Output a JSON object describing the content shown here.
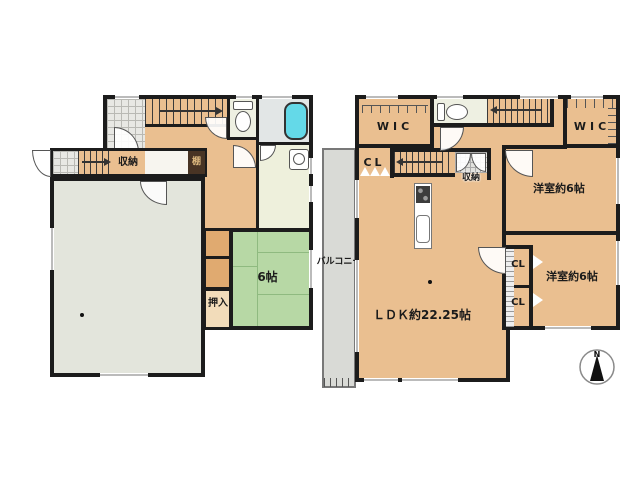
{
  "plan1f": {
    "storage_label": "収納",
    "shelf_label": "棚",
    "oshiire_label": "押入",
    "tatami_size_label": "6帖"
  },
  "plan2f": {
    "wic_left_label": "WIC",
    "wic_right_label": "WIC",
    "hall_closet_label": "CL",
    "storage_label": "収納",
    "bedroom_top_label": "洋室約6帖",
    "bedroom_bottom_label": "洋室約6帖",
    "closet_upper_label": "CL",
    "closet_lower_label": "CL",
    "ldk_label": "ＬＤＫ約22.25帖",
    "balcony_label": "バルコニー"
  },
  "compass": {
    "north_label": "N"
  },
  "colors": {
    "wall": "#1c1c1c",
    "wood_floor": "#eabf90",
    "tatami_green": "#b7d8a5",
    "large_room_gray": "#e3e5dc",
    "balcony_gray": "#d9dad6",
    "bathtub_cyan": "#64d9e8",
    "shelf_brown": "#483424"
  }
}
